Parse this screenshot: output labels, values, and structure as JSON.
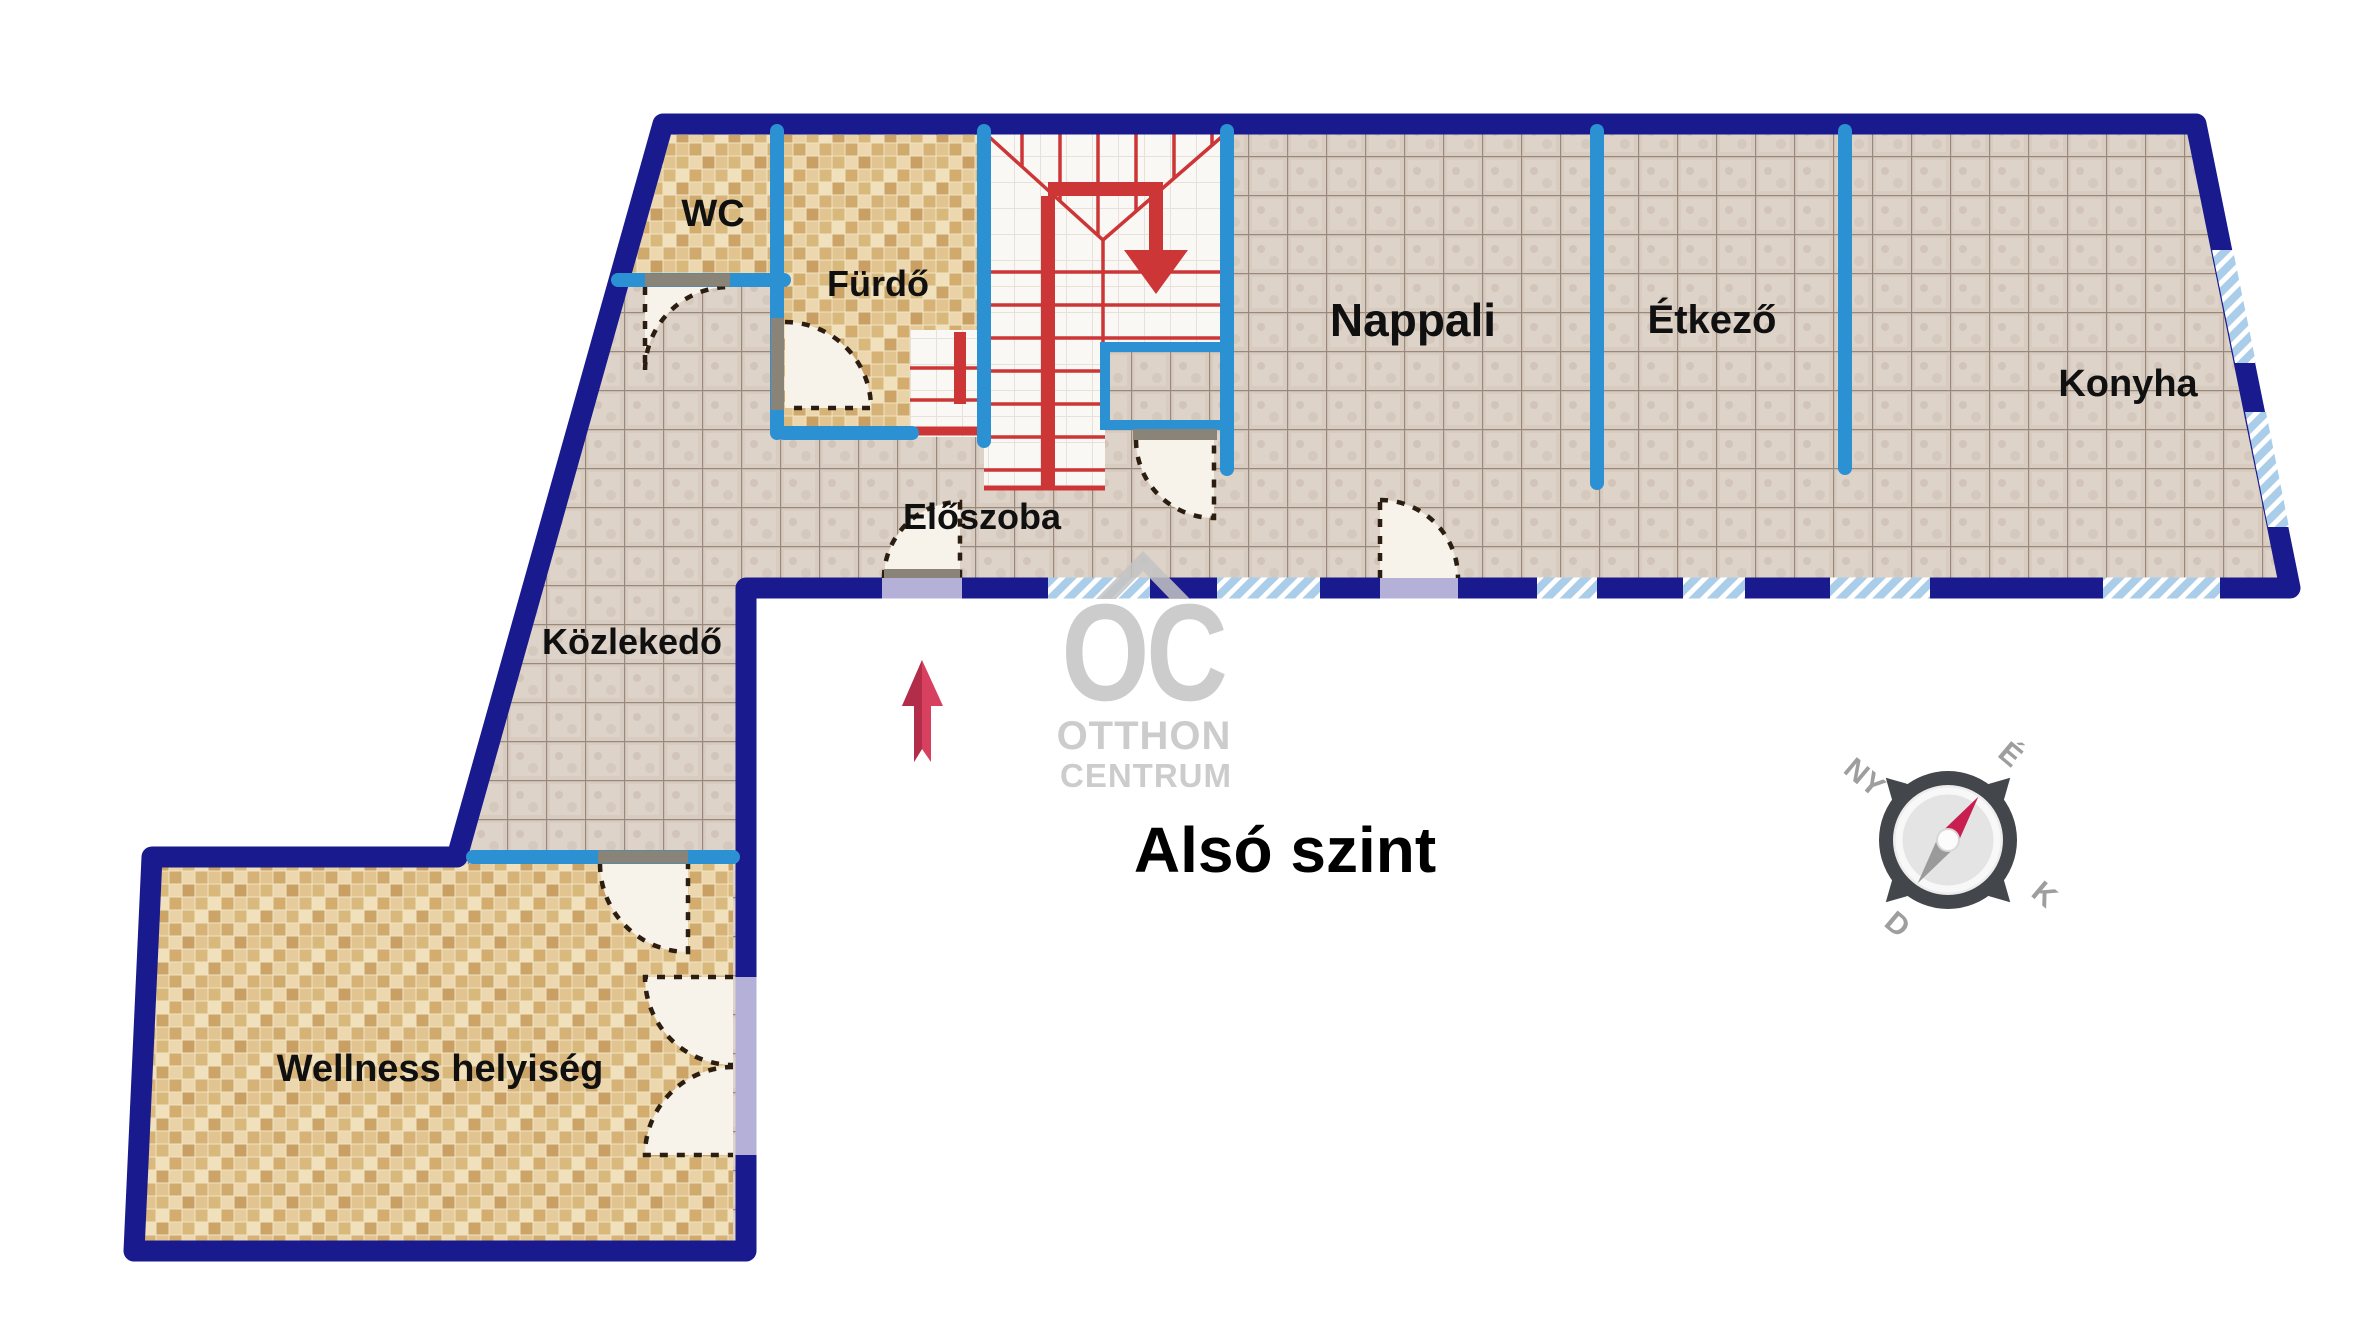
{
  "title": "Alsó szint",
  "rooms": {
    "wc": {
      "label": "WC"
    },
    "furdo": {
      "label": "Fürdő"
    },
    "eloszoba": {
      "label": "Előszoba"
    },
    "nappali": {
      "label": "Nappali"
    },
    "etkezo": {
      "label": "Étkező"
    },
    "konyha": {
      "label": "Konyha"
    },
    "kozlekedo": {
      "label": "Közlekedő"
    },
    "wellness": {
      "label": "Wellness helyiség"
    }
  },
  "watermark": {
    "line1": "OC",
    "line2": "OTTHON",
    "line3": "CENTRUM"
  },
  "compass": {
    "north": "É",
    "east": "K",
    "south": "D",
    "west": "NY"
  },
  "colors": {
    "outer_wall_navy": "#191a8d",
    "partition_blue": "#2b91d2",
    "stairs_red": "#cc3636",
    "window_hatch_blue": "#aacdea",
    "floor_tile_grey": "#d8ccc1",
    "floor_mosaic_beige": "#e6cc9c",
    "stair_floor_white": "#faf8f5",
    "door_leaf_grey": "#8a8478",
    "threshold_lavender": "#b5b0d8",
    "north_arrow_pink": "#d84060",
    "watermark_grey": "#c4c4c4",
    "label_black": "#101010"
  }
}
